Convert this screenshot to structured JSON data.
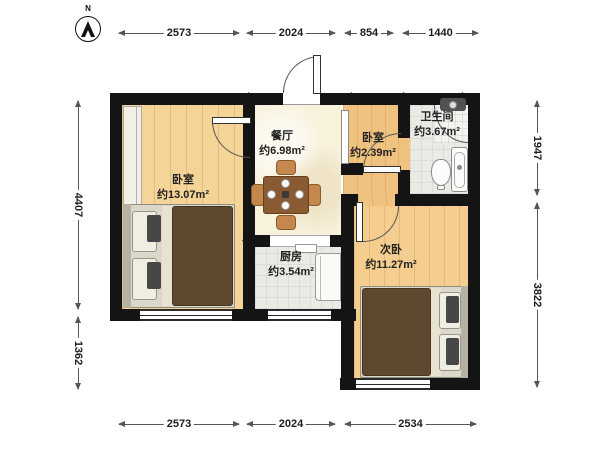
{
  "compass": {
    "label": "N"
  },
  "rooms": {
    "bedroom_left": {
      "name": "卧室",
      "area": "约13.07m²"
    },
    "dining": {
      "name": "餐厅",
      "area": "约6.98m²"
    },
    "bedroom_small": {
      "name": "卧室",
      "area": "约2.39m²"
    },
    "bathroom": {
      "name": "卫生间",
      "area": "约3.67m²"
    },
    "kitchen": {
      "name": "厨房",
      "area": "约3.54m²"
    },
    "bedroom_second": {
      "name": "次卧",
      "area": "约11.27m²"
    }
  },
  "dimensions": {
    "top": [
      "2573",
      "2024",
      "854",
      "1440"
    ],
    "bottom": [
      "2573",
      "2024",
      "2534"
    ],
    "left": [
      "4407",
      "1362"
    ],
    "right": [
      "1947",
      "3822"
    ]
  },
  "colors": {
    "wall": "#141414",
    "wood_light": "#F4D497",
    "wood_orange": "#EFC27F",
    "wood_second": "#F5CE8F",
    "dining_floor": "#F8F1DC",
    "tile_floor": "#ECEAE5",
    "duvet": "#5E4930"
  }
}
